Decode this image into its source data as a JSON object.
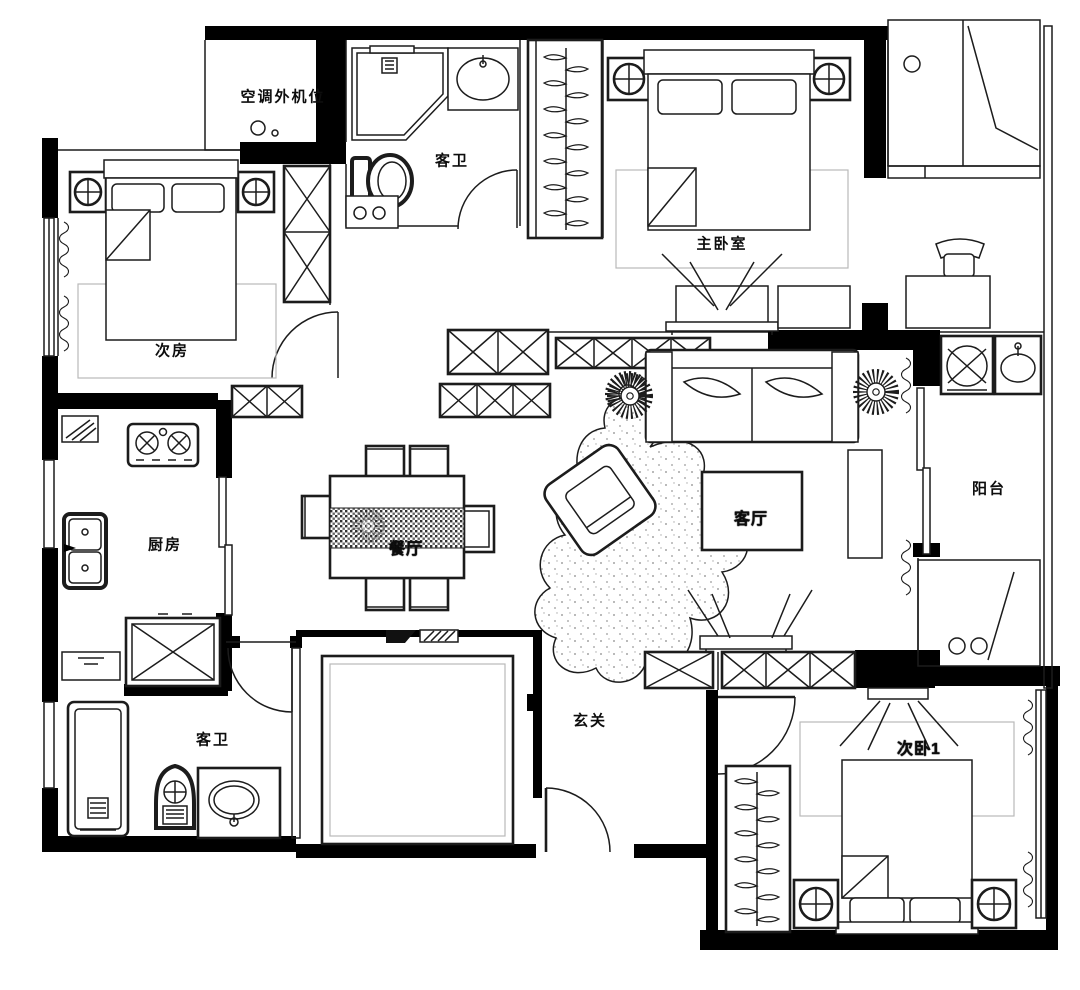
{
  "document": {
    "type": "apartment floor plan",
    "style": "black and white CAD drawing"
  },
  "colors": {
    "background": "#ffffff",
    "walls": "#000000",
    "lines": "#1c1c1c",
    "faint_lines": "#b9b9b9"
  },
  "rooms": [
    {
      "id": "ac-outdoor-unit-bay",
      "label": "空调外机位"
    },
    {
      "id": "guest-bath-top",
      "label": "客卫"
    },
    {
      "id": "master-bedroom",
      "label": "主卧室"
    },
    {
      "id": "second-room",
      "label": "次房"
    },
    {
      "id": "kitchen",
      "label": "厨房"
    },
    {
      "id": "dining-room",
      "label": "餐厅"
    },
    {
      "id": "living-room",
      "label": "客厅"
    },
    {
      "id": "balcony",
      "label": "阳台"
    },
    {
      "id": "guest-bath-bottom",
      "label": "客卫"
    },
    {
      "id": "entry-hall",
      "label": "玄关"
    },
    {
      "id": "second-bedroom-1",
      "label": "次卧1"
    }
  ]
}
